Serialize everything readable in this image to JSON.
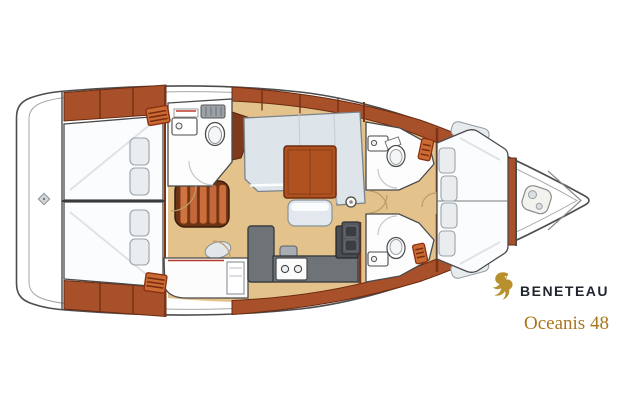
{
  "branding": {
    "brand": "BENETEAU",
    "model": "Oceanis 48",
    "brand_text_color": "#20252e",
    "model_text_color": "#ab751d",
    "logo_gold": "#b8902e"
  },
  "figure": {
    "type": "sailboat-interior-floor-plan",
    "orientation": "bow-right"
  },
  "palette": {
    "hull_outline": "#4d4d4d",
    "deck_inner_line": "#a7a7a7",
    "wood_trim": "#a8502a",
    "wood_dark": "#7f3a1b",
    "steps_wood": "#c4673a",
    "cabin_floor": "#e3c28c",
    "table_wood": "#b0521f",
    "galley_counter": "#6e7377",
    "stove": "#4a4e52",
    "upholstery": "#dde4ea",
    "bed_linen": "#fbfcfd",
    "door_arc": "#bd9c66"
  }
}
